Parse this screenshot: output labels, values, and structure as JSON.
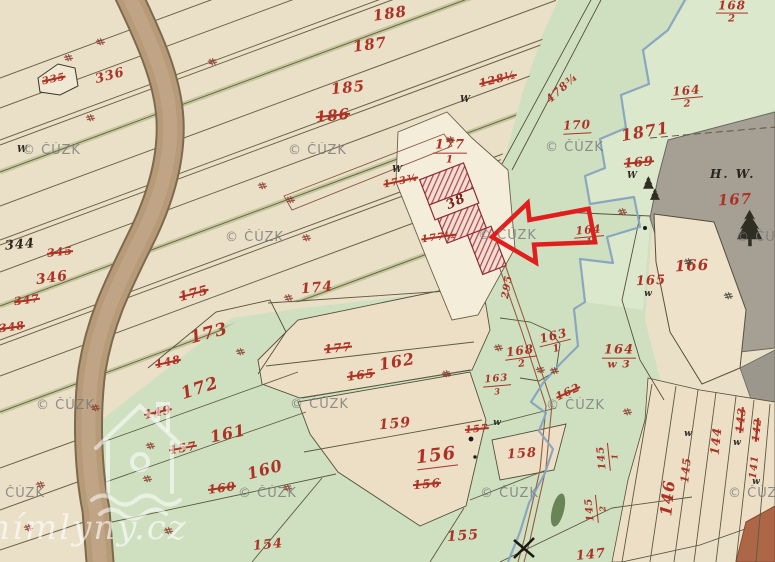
{
  "map": {
    "title": "Historical cadastral map sheet",
    "copyright_watermark": "© ČÚZK",
    "watermark_site": "anímlyny.cz",
    "hw_label": "H. W.",
    "highlight": {
      "building_number": "38",
      "arrow_color": "#e21d1d"
    },
    "palette": {
      "paper": "#eadfc7",
      "field_green": "#cfe0c1",
      "forest_gray": "#a6a094",
      "road_brown": "#b79a78",
      "stream_blue": "#86a3bf",
      "number_red": "#ad3226",
      "highlight_red": "#e21d1d"
    },
    "labels": [
      {
        "t": "188",
        "x": 390,
        "y": 14,
        "r": -8,
        "s": 15
      },
      {
        "t": "187",
        "x": 370,
        "y": 45,
        "r": -8,
        "s": 15
      },
      {
        "t": "185",
        "x": 348,
        "y": 88,
        "r": -6,
        "s": 15
      },
      {
        "t": "186",
        "x": 333,
        "y": 116,
        "r": -6,
        "s": 15,
        "k": 1
      },
      {
        "t": "128½",
        "x": 498,
        "y": 79,
        "r": -14,
        "s": 11,
        "k": 1
      },
      {
        "t": "478¾",
        "x": 562,
        "y": 88,
        "r": -42,
        "s": 11
      },
      {
        "t": "177",
        "den": "1",
        "x": 450,
        "y": 152,
        "r": 0,
        "s": 13
      },
      {
        "t": "336",
        "x": 110,
        "y": 76,
        "r": -15,
        "s": 13
      },
      {
        "t": "335",
        "x": 54,
        "y": 80,
        "r": -12,
        "s": 10,
        "k": 1
      },
      {
        "t": "344",
        "x": 20,
        "y": 245,
        "r": -5,
        "s": 13,
        "c": "black"
      },
      {
        "t": "345",
        "x": 60,
        "y": 252,
        "r": -6,
        "s": 11,
        "k": 1
      },
      {
        "t": "346",
        "x": 52,
        "y": 278,
        "r": -8,
        "s": 14
      },
      {
        "t": "347",
        "x": 27,
        "y": 300,
        "r": -8,
        "s": 11,
        "k": 1
      },
      {
        "t": "348",
        "x": 12,
        "y": 327,
        "r": -8,
        "s": 11,
        "k": 1
      },
      {
        "t": "175",
        "x": 194,
        "y": 294,
        "r": -15,
        "s": 13,
        "k": 1
      },
      {
        "t": "173",
        "x": 209,
        "y": 334,
        "r": -15,
        "s": 17
      },
      {
        "t": "148",
        "x": 168,
        "y": 362,
        "r": -12,
        "s": 11,
        "k": 1
      },
      {
        "t": "174",
        "x": 317,
        "y": 288,
        "r": -5,
        "s": 14
      },
      {
        "t": "177",
        "x": 338,
        "y": 348,
        "r": -6,
        "s": 12,
        "k": 1
      },
      {
        "t": "165",
        "x": 361,
        "y": 375,
        "r": -8,
        "s": 12,
        "k": 1
      },
      {
        "t": "162",
        "x": 397,
        "y": 362,
        "r": -10,
        "s": 16
      },
      {
        "t": "149",
        "x": 158,
        "y": 412,
        "r": -12,
        "s": 12,
        "k": 1
      },
      {
        "t": "172",
        "x": 200,
        "y": 389,
        "r": -18,
        "s": 17
      },
      {
        "t": "157",
        "x": 183,
        "y": 448,
        "r": -10,
        "s": 12,
        "k": 1
      },
      {
        "t": "161",
        "x": 228,
        "y": 434,
        "r": -12,
        "s": 16
      },
      {
        "t": "160",
        "x": 222,
        "y": 488,
        "r": -8,
        "s": 12,
        "k": 1
      },
      {
        "t": "160",
        "x": 265,
        "y": 470,
        "r": -15,
        "s": 16
      },
      {
        "t": "154",
        "x": 268,
        "y": 545,
        "r": -6,
        "s": 13
      },
      {
        "t": "159",
        "x": 395,
        "y": 424,
        "r": -5,
        "s": 14
      },
      {
        "t": "156",
        "x": 436,
        "y": 456,
        "r": -7,
        "s": 18,
        "u": 1
      },
      {
        "t": "156",
        "x": 427,
        "y": 484,
        "r": -5,
        "s": 12,
        "k": 1
      },
      {
        "t": "155",
        "x": 463,
        "y": 536,
        "r": -4,
        "s": 14
      },
      {
        "t": "158",
        "x": 522,
        "y": 454,
        "r": -4,
        "s": 13
      },
      {
        "t": "157",
        "x": 477,
        "y": 430,
        "r": -5,
        "s": 10,
        "k": 1
      },
      {
        "t": "147",
        "x": 591,
        "y": 555,
        "r": -6,
        "s": 13
      },
      {
        "t": "163",
        "den": "3",
        "x": 497,
        "y": 385,
        "r": -5,
        "s": 10,
        "k": 1
      },
      {
        "t": "295",
        "x": 508,
        "y": 287,
        "r": -80,
        "s": 10
      },
      {
        "t": "38",
        "x": 456,
        "y": 202,
        "r": -25,
        "s": 13,
        "c": "dark"
      },
      {
        "t": "173¾",
        "x": 401,
        "y": 182,
        "r": -12,
        "s": 10,
        "k": 1
      },
      {
        "t": "177½",
        "x": 439,
        "y": 238,
        "r": -8,
        "s": 10,
        "k": 1
      },
      {
        "t": "168",
        "den": "2",
        "x": 521,
        "y": 357,
        "r": -8,
        "s": 12
      },
      {
        "t": "163",
        "den": "1",
        "x": 555,
        "y": 342,
        "r": -14,
        "s": 12
      },
      {
        "t": "164",
        "den": "w 3",
        "x": 619,
        "y": 357,
        "r": 0,
        "s": 13
      },
      {
        "t": "164",
        "den": "1",
        "x": 589,
        "y": 236,
        "r": -5,
        "s": 11
      },
      {
        "t": "162",
        "x": 568,
        "y": 392,
        "r": -25,
        "s": 11,
        "k": 1
      },
      {
        "t": "166",
        "x": 692,
        "y": 266,
        "r": -3,
        "s": 15
      },
      {
        "t": "165",
        "x": 651,
        "y": 281,
        "r": -3,
        "s": 13
      },
      {
        "t": "167",
        "x": 735,
        "y": 200,
        "r": -3,
        "s": 15
      },
      {
        "t": "168",
        "den": "2",
        "x": 732,
        "y": 12,
        "r": 0,
        "s": 12
      },
      {
        "t": "164",
        "den": "2",
        "x": 687,
        "y": 97,
        "r": -5,
        "s": 12
      },
      {
        "t": "170",
        "x": 577,
        "y": 125,
        "r": -3,
        "s": 12,
        "u": 1
      },
      {
        "t": "1871",
        "x": 645,
        "y": 132,
        "r": -10,
        "s": 16
      },
      {
        "t": "169",
        "x": 639,
        "y": 163,
        "r": -5,
        "s": 13,
        "k": 1
      },
      {
        "t": "146",
        "x": 668,
        "y": 498,
        "r": -84,
        "s": 16
      },
      {
        "t": "145",
        "x": 686,
        "y": 470,
        "r": -84,
        "s": 11
      },
      {
        "t": "144",
        "x": 716,
        "y": 441,
        "r": -84,
        "s": 12
      },
      {
        "t": "143",
        "x": 741,
        "y": 420,
        "r": -84,
        "s": 11,
        "k": 1
      },
      {
        "t": "142",
        "x": 758,
        "y": 430,
        "r": -84,
        "s": 10,
        "k": 1
      },
      {
        "t": "141",
        "x": 755,
        "y": 467,
        "r": -84,
        "s": 10
      },
      {
        "t": "145",
        "den": "1",
        "x": 608,
        "y": 457,
        "r": -96,
        "s": 10
      },
      {
        "t": "145",
        "den": "2",
        "x": 596,
        "y": 509,
        "r": -96,
        "s": 10
      }
    ],
    "letter_marks": [
      {
        "t": "W",
        "x": 22,
        "y": 150
      },
      {
        "t": "W",
        "x": 397,
        "y": 170
      },
      {
        "t": "W",
        "x": 465,
        "y": 100
      },
      {
        "t": "W",
        "x": 632,
        "y": 176
      },
      {
        "t": "w",
        "x": 648,
        "y": 294
      },
      {
        "t": "w",
        "x": 688,
        "y": 434
      },
      {
        "t": "w",
        "x": 737,
        "y": 443
      },
      {
        "t": "w",
        "x": 756,
        "y": 482
      },
      {
        "t": "w",
        "x": 497,
        "y": 423
      }
    ],
    "watermarks": [
      {
        "x": 22,
        "y": 143
      },
      {
        "x": 288,
        "y": 143
      },
      {
        "x": 545,
        "y": 140
      },
      {
        "x": 225,
        "y": 230
      },
      {
        "x": 478,
        "y": 228
      },
      {
        "x": 736,
        "y": 230
      },
      {
        "x": 36,
        "y": 398
      },
      {
        "x": 290,
        "y": 397
      },
      {
        "x": 546,
        "y": 398
      },
      {
        "x": -14,
        "y": 486
      },
      {
        "x": 238,
        "y": 486
      },
      {
        "x": 480,
        "y": 486
      },
      {
        "x": 728,
        "y": 486
      }
    ],
    "hash_marks": [
      [
        100,
        42,
        65
      ],
      [
        68,
        58,
        65
      ],
      [
        212,
        62,
        65
      ],
      [
        90,
        118,
        65
      ],
      [
        262,
        186,
        65
      ],
      [
        306,
        238,
        65
      ],
      [
        288,
        298,
        65
      ],
      [
        240,
        352,
        65
      ],
      [
        150,
        446,
        65
      ],
      [
        147,
        479,
        65
      ],
      [
        168,
        531,
        65
      ],
      [
        287,
        488,
        65
      ],
      [
        446,
        374,
        65
      ],
      [
        554,
        371,
        65
      ],
      [
        622,
        212,
        65
      ],
      [
        688,
        262,
        65,
        "d"
      ],
      [
        728,
        296,
        65,
        "d"
      ],
      [
        627,
        412,
        65
      ],
      [
        540,
        370,
        60
      ],
      [
        40,
        485,
        65
      ],
      [
        28,
        528,
        65
      ],
      [
        95,
        408,
        65
      ],
      [
        498,
        348,
        65
      ],
      [
        290,
        200,
        65
      ],
      [
        450,
        140,
        65
      ]
    ]
  }
}
